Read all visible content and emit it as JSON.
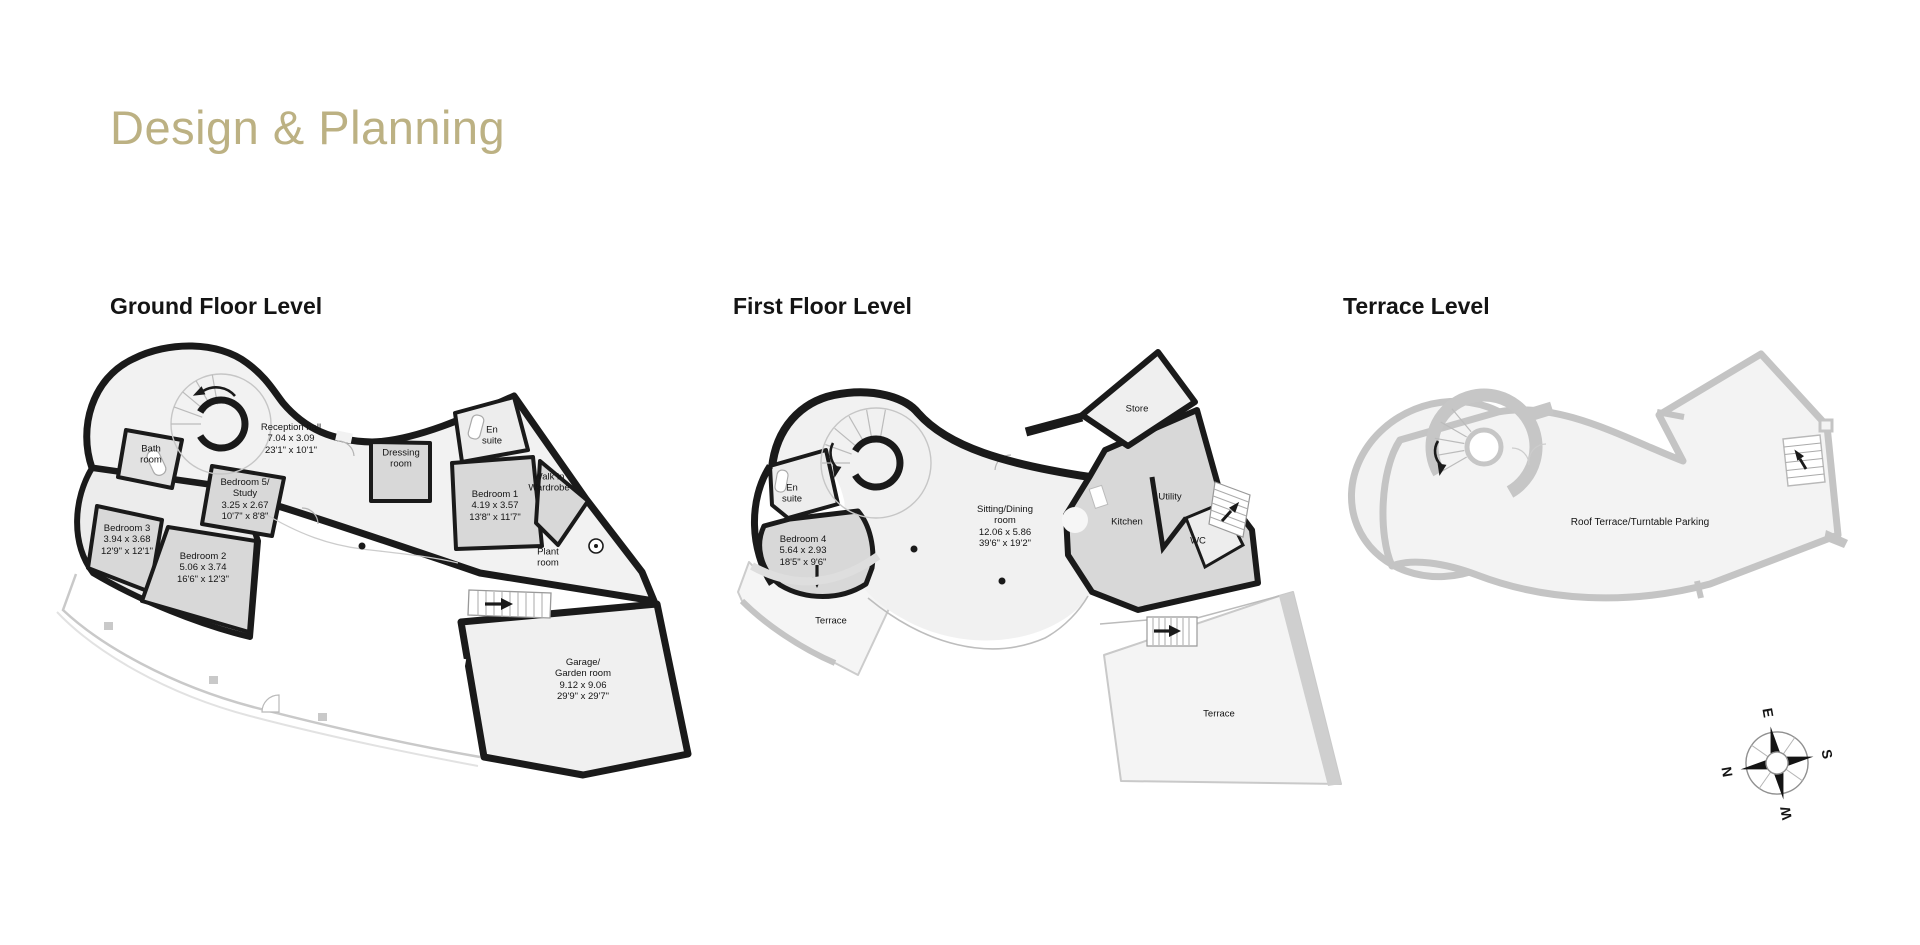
{
  "page": {
    "title": "Design & Planning",
    "title_color": "#bcb183",
    "heading_color": "#141414",
    "wall_color": "#1a1a1a",
    "terrace_wall_color": "#c4c4c4"
  },
  "plans": {
    "ground": {
      "heading": "Ground Floor Level",
      "rooms": {
        "bath": "Bath\nroom",
        "reception": "Reception hall\n7.04 x 3.09\n23'1\" x 10'1\"",
        "dressing": "Dressing\nroom",
        "bedroom5": "Bedroom 5/\nStudy\n3.25 x 2.67\n10'7\" x 8'8\"",
        "bedroom3": "Bedroom 3\n3.94 x 3.68\n12'9\" x 12'1\"",
        "bedroom2": "Bedroom 2\n5.06 x 3.74\n16'6\" x 12'3\"",
        "ensuite": "En\nsuite",
        "bedroom1": "Bedroom 1\n4.19 x 3.57\n13'8\" x 11'7\"",
        "walkin": "Walk in\nWardrobe",
        "plant": "Plant\nroom",
        "garage": "Garage/\nGarden room\n9.12 x 9.06\n29'9\" x 29'7\""
      }
    },
    "first": {
      "heading": "First Floor Level",
      "rooms": {
        "store": "Store",
        "ensuite": "En\nsuite",
        "bedroom4": "Bedroom 4\n5.64 x 2.93\n18'5\" x 9'6\"",
        "terrace_left": "Terrace",
        "sitting": "Sitting/Dining\nroom\n12.06 x 5.86\n39'6\" x 19'2\"",
        "kitchen": "Kitchen",
        "utility": "Utility",
        "wc": "WC",
        "terrace_lower": "Terrace"
      }
    },
    "terrace": {
      "heading": "Terrace Level",
      "rooms": {
        "roof": "Roof Terrace/Turntable Parking"
      }
    }
  },
  "compass": {
    "n": "N",
    "e": "E",
    "s": "S",
    "w": "W"
  }
}
